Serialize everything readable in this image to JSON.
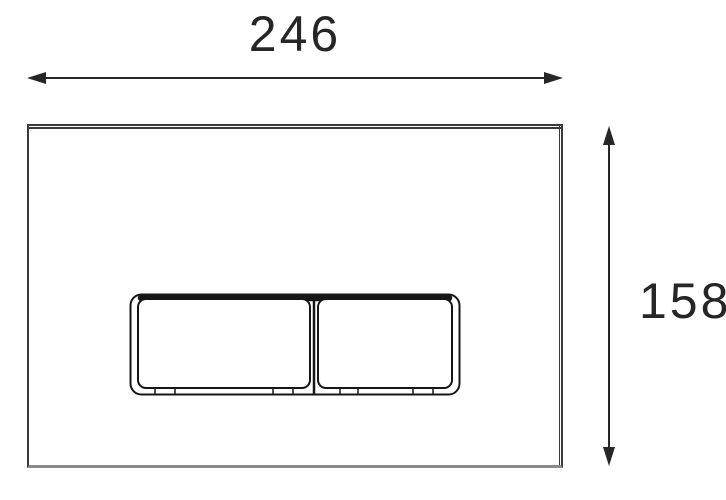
{
  "drawing": {
    "kind": "technical-dimension-drawing",
    "line_color": "#262626",
    "plate_edge_color": "#3a3a3a",
    "plate_shadow_color": "#8a8a8a",
    "width_dimension": {
      "value": "246"
    },
    "height_dimension": {
      "value": "158"
    }
  }
}
